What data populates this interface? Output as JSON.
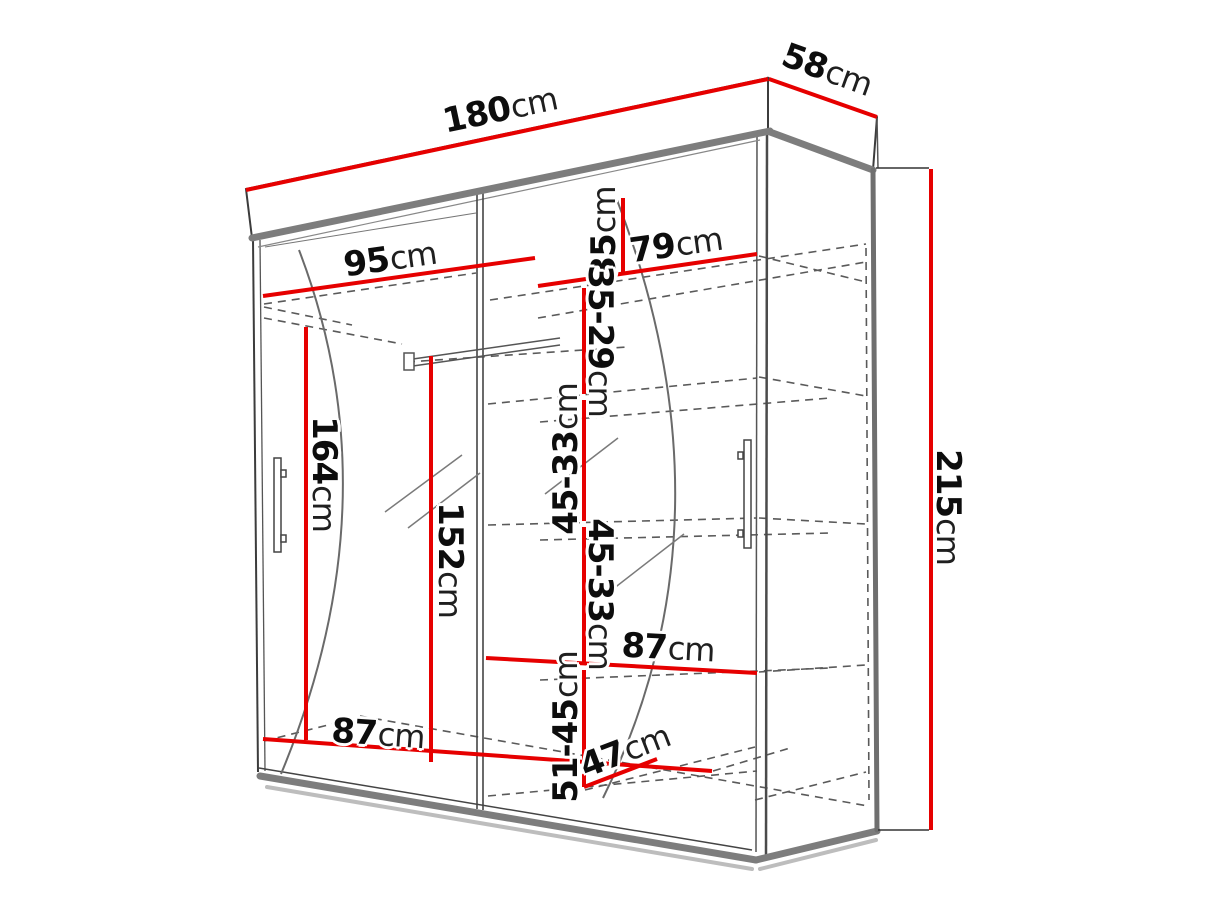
{
  "diagram": {
    "type": "wardrobe-dimension-drawing",
    "unit": "cm",
    "accent_color": "#e60000",
    "outline_color": "#3c3c3c",
    "panel_edge_color": "#7d7d7d",
    "overall": {
      "width": "180",
      "depth": "58",
      "height": "215"
    },
    "labels": {
      "w180": {
        "value": "180",
        "unit": "cm"
      },
      "d58": {
        "value": "58",
        "unit": "cm"
      },
      "h215": {
        "value": "215",
        "unit": "cm"
      },
      "w95": {
        "value": "95",
        "unit": "cm"
      },
      "w79": {
        "value": "79",
        "unit": "cm"
      },
      "h35": {
        "value": "35",
        "unit": "cm"
      },
      "h35_29": {
        "value": "35-29",
        "unit": "cm"
      },
      "h45_33a": {
        "value": "45-33",
        "unit": "cm"
      },
      "h45_33b": {
        "value": "45-33",
        "unit": "cm"
      },
      "h51_45": {
        "value": "51-45",
        "unit": "cm"
      },
      "h164": {
        "value": "164",
        "unit": "cm"
      },
      "h152": {
        "value": "152",
        "unit": "cm"
      },
      "w87_right": {
        "value": "87",
        "unit": "cm"
      },
      "w87_left": {
        "value": "87",
        "unit": "cm"
      },
      "d47": {
        "value": "47",
        "unit": "cm"
      }
    }
  }
}
